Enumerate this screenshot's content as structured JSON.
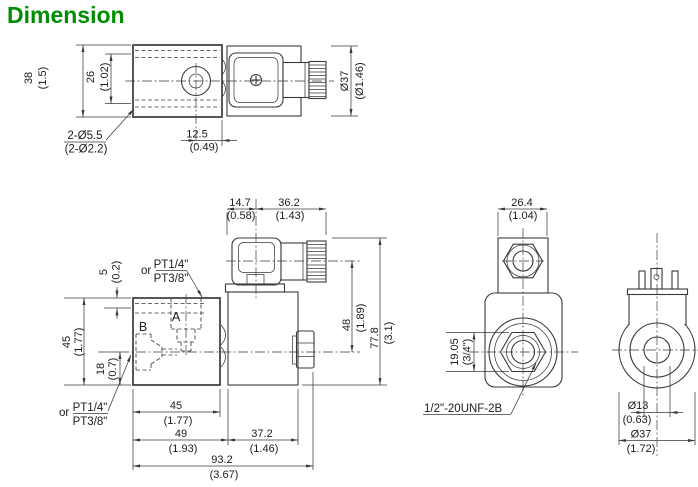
{
  "title": "Dimension",
  "colors": {
    "title_green": "#008f00",
    "line": "#3a3a3a",
    "background": "#ffffff"
  },
  "top_view": {
    "height_mm": "38",
    "height_in": "(1.5)",
    "hole_spacing_mm": "26",
    "hole_spacing_in": "(1.02)",
    "mounting_holes_mm": "2-Ø5.5",
    "mounting_holes_in": "(2-Ø2.2)",
    "hole_offset_mm": "12.5",
    "hole_offset_in": "(0.49)",
    "coil_dia_mm": "Ø37",
    "coil_dia_in": "(Ø1.46)"
  },
  "front_view": {
    "connector_left_mm": "14.7",
    "connector_left_in": "(0.58)",
    "connector_right_mm": "36.2",
    "connector_right_in": "(1.43)",
    "port_a_depth_mm": "5",
    "port_a_depth_in": "(0.2)",
    "body_height_mm": "45",
    "body_height_in": "(1.77)",
    "port_b_height_mm": "18",
    "port_b_height_in": "(0.7)",
    "axis_to_connector_mm": "48",
    "axis_to_connector_in": "(1.89)",
    "total_height_mm": "77.8",
    "total_height_in": "(3.1)",
    "body_width_mm": "45",
    "body_width_in": "(1.77)",
    "body_to_coil_mm": "49",
    "body_to_coil_in": "(1.93)",
    "coil_width_mm": "37.2",
    "coil_width_in": "(1.46)",
    "total_length_mm": "93.2",
    "total_length_in": "(3.67)",
    "port_a_label": "A",
    "port_b_label": "B",
    "or_label": "or",
    "thread_option_1": "PT1/4\"",
    "thread_option_2": "PT3/8\""
  },
  "side_view": {
    "cap_width_mm": "26.4",
    "cap_width_in": "(1.04)",
    "hex_flats_mm": "19.05",
    "hex_flats_in": "(3/4\")",
    "stem_thread": "1/2\"-20UNF-2B"
  },
  "coil_view": {
    "bore_dia_mm": "Ø13",
    "bore_dia_in": "(0.63)",
    "outer_dia_mm": "Ø37",
    "outer_dia_in": "(1.72)"
  }
}
